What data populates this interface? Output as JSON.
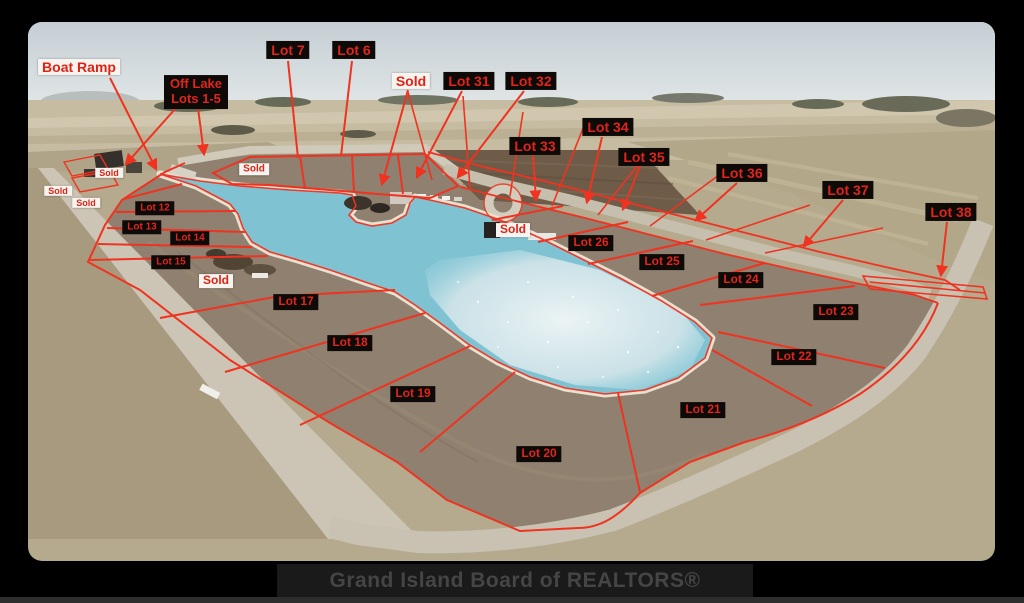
{
  "watermark": {
    "text": "Grand Island Board of REALTORS®"
  },
  "colors": {
    "annotation_red": "#ef3320",
    "label_text_red": "#e0251c",
    "label_black_bg": "#0d0a08",
    "label_white_bg": "#f7f4ef",
    "lake_blue": "#7fc3d3",
    "lake_glint_white": "#e7eef0",
    "sky": "#c9d3d8",
    "field_tan": "#b5a98e",
    "development_dirt": "#8f8070",
    "road_gray": "#ccc5b5",
    "watermark_bar": "#1a1a1a",
    "watermark_text": "#454545",
    "frame_background": "#000000"
  },
  "map": {
    "labels": [
      {
        "id": "boat-ramp",
        "text": "Boat Ramp",
        "x": 51,
        "y": 45,
        "style": "white",
        "size": "lg"
      },
      {
        "id": "lot-7",
        "text": "Lot 7",
        "x": 260,
        "y": 28,
        "style": "black",
        "size": "lg"
      },
      {
        "id": "lot-6",
        "text": "Lot 6",
        "x": 326,
        "y": 28,
        "style": "black",
        "size": "lg"
      },
      {
        "id": "off-lake-lots-1-5",
        "lines": [
          "Off Lake",
          "Lots 1-5"
        ],
        "x": 168,
        "y": 70,
        "style": "black",
        "size": "ml"
      },
      {
        "id": "sold-north",
        "text": "Sold",
        "x": 383,
        "y": 59,
        "style": "white",
        "size": "lg"
      },
      {
        "id": "lot-31",
        "text": "Lot 31",
        "x": 441,
        "y": 59,
        "style": "black",
        "size": "lg"
      },
      {
        "id": "lot-32",
        "text": "Lot 32",
        "x": 503,
        "y": 59,
        "style": "black",
        "size": "lg"
      },
      {
        "id": "lot-33",
        "text": "Lot 33",
        "x": 507,
        "y": 124,
        "style": "black",
        "size": "lg"
      },
      {
        "id": "lot-34",
        "text": "Lot 34",
        "x": 580,
        "y": 105,
        "style": "black",
        "size": "lg"
      },
      {
        "id": "lot-35",
        "text": "Lot 35",
        "x": 616,
        "y": 135,
        "style": "black",
        "size": "lg"
      },
      {
        "id": "lot-36",
        "text": "Lot 36",
        "x": 714,
        "y": 151,
        "style": "black",
        "size": "lg"
      },
      {
        "id": "lot-37",
        "text": "Lot 37",
        "x": 820,
        "y": 168,
        "style": "black",
        "size": "lg"
      },
      {
        "id": "lot-38",
        "text": "Lot 38",
        "x": 923,
        "y": 190,
        "style": "black",
        "size": "lg"
      },
      {
        "id": "sold-house-left",
        "text": "Sold",
        "x": 81,
        "y": 151,
        "style": "white",
        "size": "xs"
      },
      {
        "id": "sold-west-1",
        "text": "Sold",
        "x": 30,
        "y": 169,
        "style": "white",
        "size": "xs"
      },
      {
        "id": "sold-west-2",
        "text": "Sold",
        "x": 58,
        "y": 181,
        "style": "white",
        "size": "xs"
      },
      {
        "id": "sold-shore-strip",
        "text": "Sold",
        "x": 226,
        "y": 147,
        "style": "white",
        "size": "sm"
      },
      {
        "id": "lot-12",
        "text": "Lot 12",
        "x": 127,
        "y": 186,
        "style": "black",
        "size": "sm"
      },
      {
        "id": "lot-13",
        "text": "Lot 13",
        "x": 114,
        "y": 205,
        "style": "black",
        "size": "sm"
      },
      {
        "id": "lot-14",
        "text": "Lot 14",
        "x": 162,
        "y": 216,
        "style": "black",
        "size": "sm"
      },
      {
        "id": "lot-15",
        "text": "Lot 15",
        "x": 143,
        "y": 240,
        "style": "black",
        "size": "sm"
      },
      {
        "id": "sold-construction",
        "text": "Sold",
        "x": 188,
        "y": 259,
        "style": "white",
        "size": "md"
      },
      {
        "id": "sold-lake-house",
        "text": "Sold",
        "x": 485,
        "y": 208,
        "style": "white",
        "size": "md"
      },
      {
        "id": "lot-26",
        "text": "Lot 26",
        "x": 563,
        "y": 221,
        "style": "black",
        "size": "md"
      },
      {
        "id": "lot-25",
        "text": "Lot 25",
        "x": 634,
        "y": 240,
        "style": "black",
        "size": "md"
      },
      {
        "id": "lot-24",
        "text": "Lot 24",
        "x": 713,
        "y": 258,
        "style": "black",
        "size": "md"
      },
      {
        "id": "lot-23",
        "text": "Lot 23",
        "x": 808,
        "y": 290,
        "style": "black",
        "size": "md"
      },
      {
        "id": "lot-22",
        "text": "Lot 22",
        "x": 766,
        "y": 335,
        "style": "black",
        "size": "md"
      },
      {
        "id": "lot-21",
        "text": "Lot 21",
        "x": 675,
        "y": 388,
        "style": "black",
        "size": "md"
      },
      {
        "id": "lot-20",
        "text": "Lot 20",
        "x": 511,
        "y": 432,
        "style": "black",
        "size": "md"
      },
      {
        "id": "lot-19",
        "text": "Lot 19",
        "x": 385,
        "y": 372,
        "style": "black",
        "size": "md"
      },
      {
        "id": "lot-18",
        "text": "Lot 18",
        "x": 322,
        "y": 321,
        "style": "black",
        "size": "md"
      },
      {
        "id": "lot-17",
        "text": "Lot 17",
        "x": 268,
        "y": 280,
        "style": "black",
        "size": "md"
      }
    ]
  }
}
